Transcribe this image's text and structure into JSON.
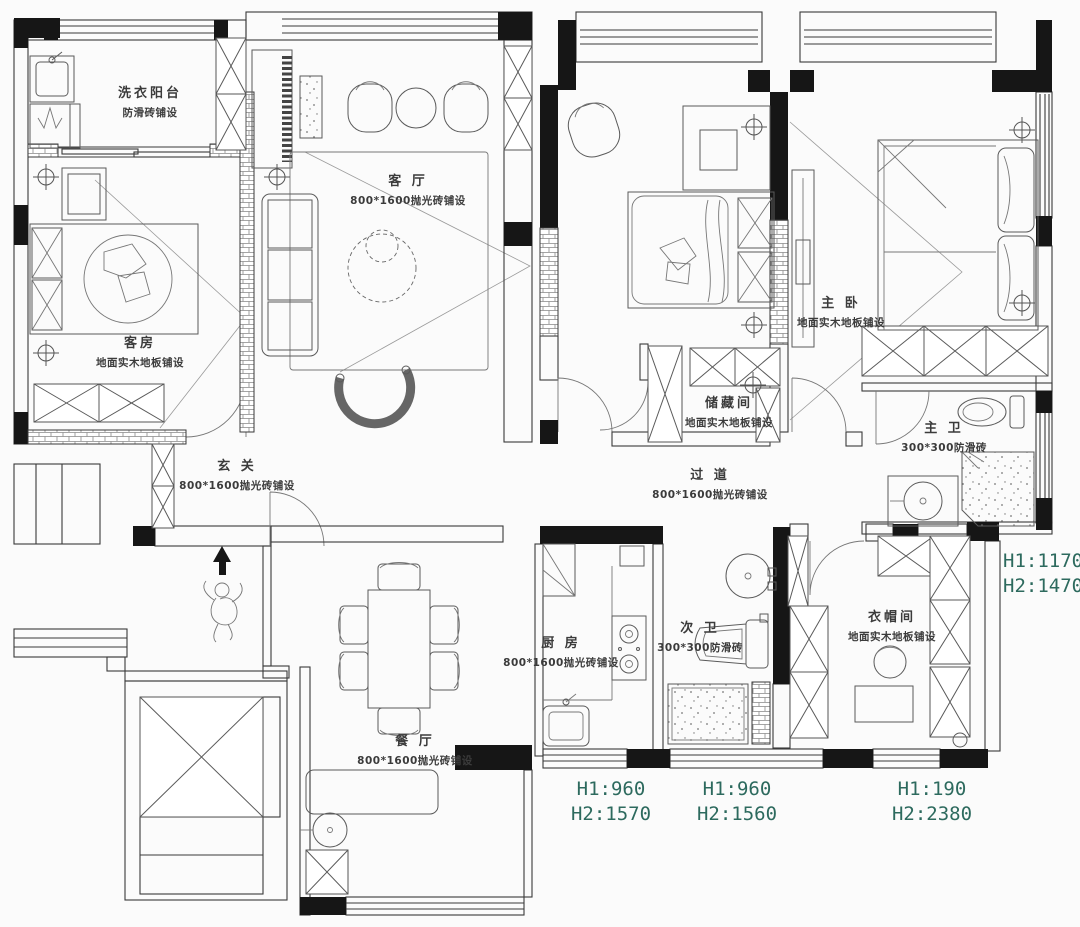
{
  "title": "apartment-floor-plan",
  "colors": {
    "wall_black": "#161616",
    "line": "#3a3a3a",
    "dimension_text": "#2d6a5e",
    "label_text": "#3b3b3b",
    "background": "#fbfbfb"
  },
  "rooms": [
    {
      "id": "laundry-balcony",
      "name": "洗衣阳台",
      "spec": "防滑砖铺设"
    },
    {
      "id": "living-room",
      "name": "客 厅",
      "spec": "800*1600抛光砖铺设"
    },
    {
      "id": "guest-room",
      "name": "客房",
      "spec": "地面实木地板铺设"
    },
    {
      "id": "foyer",
      "name": "玄 关",
      "spec": "800*1600抛光砖铺设"
    },
    {
      "id": "master-bedroom",
      "name": "主 卧",
      "spec": "地面实木地板铺设"
    },
    {
      "id": "storage-room",
      "name": "储藏间",
      "spec": "地面实木地板铺设"
    },
    {
      "id": "master-bathroom",
      "name": "主 卫",
      "spec": "300*300防滑砖"
    },
    {
      "id": "corridor",
      "name": "过 道",
      "spec": "800*1600抛光砖铺设"
    },
    {
      "id": "kitchen",
      "name": "厨 房",
      "spec": "800*1600抛光砖铺设"
    },
    {
      "id": "second-bathroom",
      "name": "次 卫",
      "spec": "300*300防滑砖"
    },
    {
      "id": "cloakroom",
      "name": "衣帽间",
      "spec": "地面实木地板铺设"
    },
    {
      "id": "dining-room",
      "name": "餐 厅",
      "spec": "800*1600抛光砖铺设"
    }
  ],
  "dimensions": [
    {
      "id": "right-window",
      "line1": "H1:1170",
      "line2": "H2:1470"
    },
    {
      "id": "kitchen-window",
      "line1": "H1:960",
      "line2": "H2:1570"
    },
    {
      "id": "bath2-window",
      "line1": "H1:960",
      "line2": "H2:1560"
    },
    {
      "id": "cloak-window",
      "line1": "H1:190",
      "line2": "H2:2380"
    }
  ],
  "symbols": {
    "north_arrow": "north-arrow",
    "ceiling_light": "crosshair-circle"
  }
}
